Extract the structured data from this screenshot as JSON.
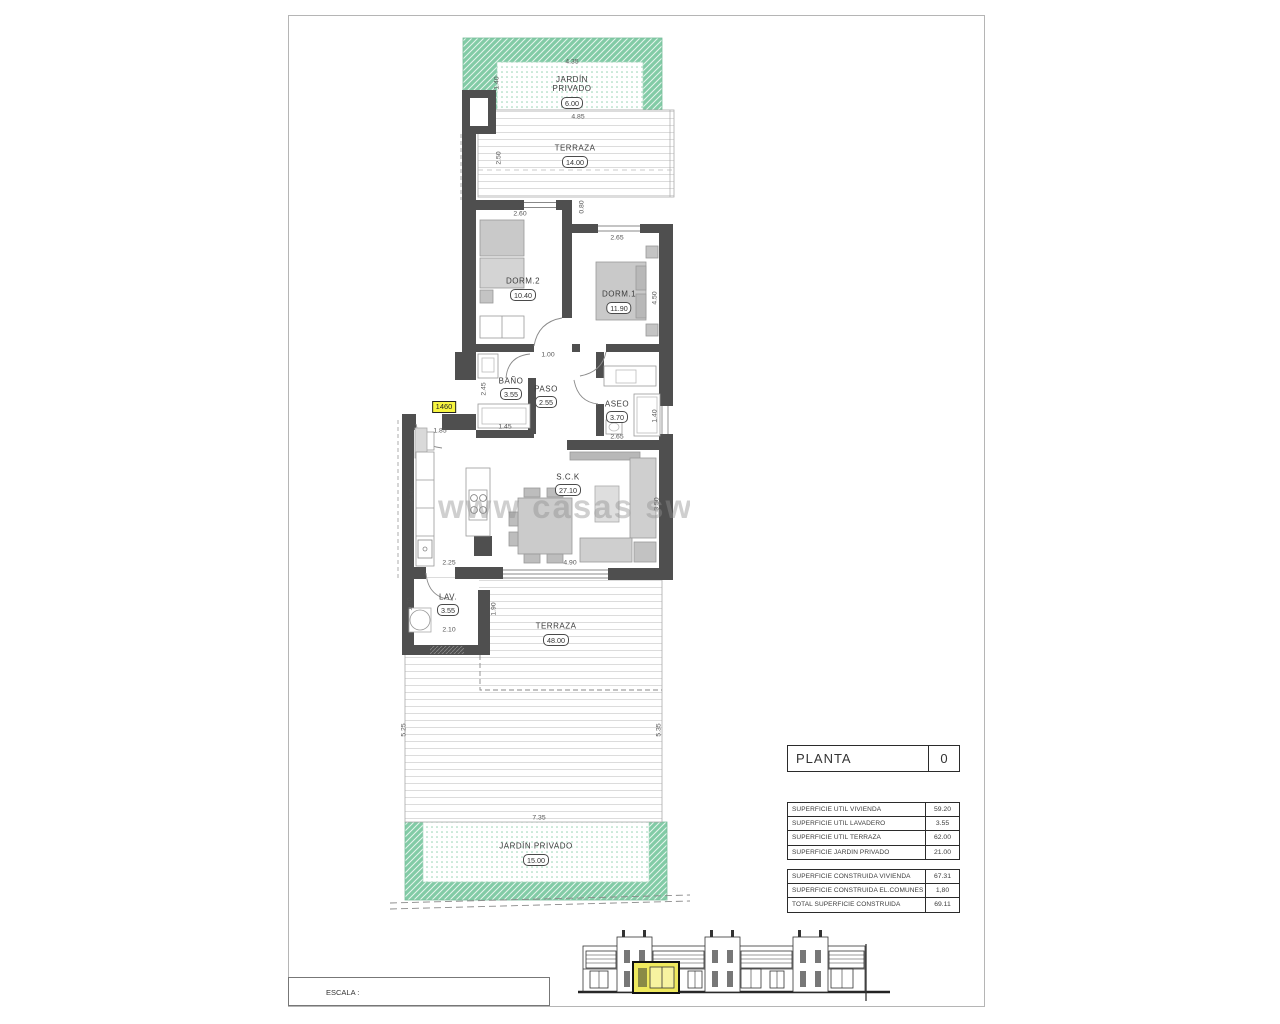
{
  "watermark": "www casas swils",
  "plan": {
    "unit_ref": "1460",
    "rooms": [
      {
        "id": "jardin-top",
        "name": "JARDÍN\nPRIVADO",
        "area": "6.00"
      },
      {
        "id": "terraza-top",
        "name": "TERRAZA",
        "area": "14.00"
      },
      {
        "id": "dorm2",
        "name": "DORM.2",
        "area": "10.40"
      },
      {
        "id": "dorm1",
        "name": "DORM.1",
        "area": "11.90"
      },
      {
        "id": "bano",
        "name": "BAÑO",
        "area": "3.55"
      },
      {
        "id": "paso",
        "name": "PASO",
        "area": "2.55"
      },
      {
        "id": "aseo",
        "name": "ASEO",
        "area": "3.70"
      },
      {
        "id": "sck",
        "name": "S.C.K",
        "area": "27.10"
      },
      {
        "id": "lav",
        "name": "LAV.",
        "area": "3.55"
      },
      {
        "id": "terraza-main",
        "name": "TERRAZA",
        "area": "48.00"
      },
      {
        "id": "jardin-bottom",
        "name": "JARDÍN PRIVADO",
        "area": "15.00"
      }
    ],
    "dimensions": [
      {
        "t": "4.35"
      },
      {
        "t": "1.40"
      },
      {
        "t": "4.85"
      },
      {
        "t": "2.50"
      },
      {
        "t": "2.60"
      },
      {
        "t": "0.80"
      },
      {
        "t": "2.65"
      },
      {
        "t": "4.50"
      },
      {
        "t": "1.00"
      },
      {
        "t": "2.45"
      },
      {
        "t": "1.45"
      },
      {
        "t": "1.85"
      },
      {
        "t": "2.65"
      },
      {
        "t": "1.40"
      },
      {
        "t": "4.10"
      },
      {
        "t": "3.50"
      },
      {
        "t": "2.25"
      },
      {
        "t": "4.90"
      },
      {
        "t": "1.70"
      },
      {
        "t": "2.10"
      },
      {
        "t": "1.90"
      },
      {
        "t": "5.25"
      },
      {
        "t": "5.35"
      },
      {
        "t": "7.35"
      }
    ],
    "colors": {
      "wall": "#4f4f4f",
      "garden": "#82cba6",
      "highlight": "#f7f540"
    }
  },
  "title_block": {
    "floor_label": "PLANTA",
    "floor_number": "0",
    "surface_table": {
      "rows": [
        {
          "label": "SUPERFICIE ÚTIL VIVIENDA",
          "value": "59.20"
        },
        {
          "label": "SUPERFICIE ÚTIL LAVADERO",
          "value": "3.55"
        },
        {
          "label": "SUPERFICIE ÚTIL TERRAZA",
          "value": "62.00"
        },
        {
          "label": "SUPERFICIE JARDÍN PRIVADO",
          "value": "21.00"
        }
      ]
    },
    "construction_table": {
      "rows": [
        {
          "label": "SUPERFICIE CONSTRUIDA VIVIENDA",
          "value": "67.31"
        },
        {
          "label": "SUPERFICIE CONSTRUIDA EL.COMUNES",
          "value": "1,80"
        },
        {
          "label": "TOTAL SUPERFICIE CONSTRUIDA",
          "value": "69.11"
        }
      ]
    }
  },
  "scale_bar": {
    "label": "ESCALA :",
    "north": "N",
    "ticks": [
      "0",
      "1",
      "2",
      "3",
      "4",
      "5"
    ]
  }
}
